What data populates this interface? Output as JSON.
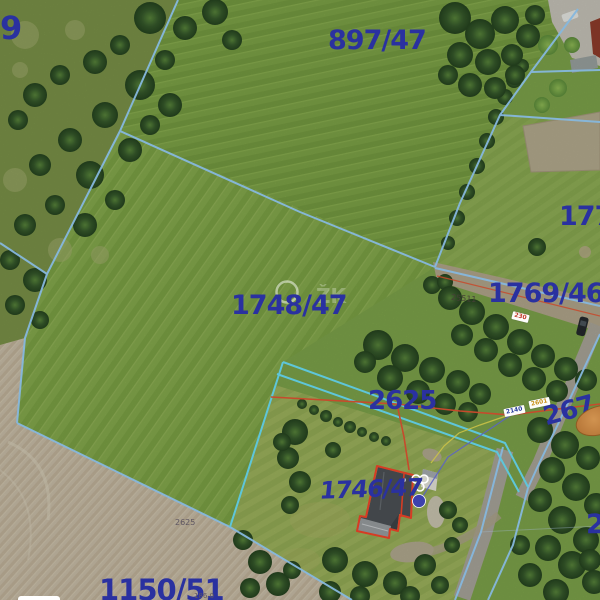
{
  "map": {
    "watermark": "ŽK",
    "parcel_labels": {
      "p9": "9",
      "p897": "897/47",
      "p177": "177",
      "p1769": "1769/46",
      "p1748": "1748/47",
      "p2625": "2625",
      "p1746": "1746/47",
      "p267": "267",
      "p2": "2",
      "p1150": "1150/51"
    },
    "small_labels": {
      "s2625": "2625",
      "s25511": "25511",
      "s186": "186.0"
    },
    "road_labels": {
      "r230": "230",
      "r2140": "2140",
      "r2601": "2601"
    },
    "colors": {
      "parcel_number": "#2a31a0",
      "boundary_blue": "#86b8de",
      "boundary_cyan": "#5ec6da",
      "boundary_red": "#c74a2c",
      "highlight_orange": "#b06f32"
    }
  }
}
